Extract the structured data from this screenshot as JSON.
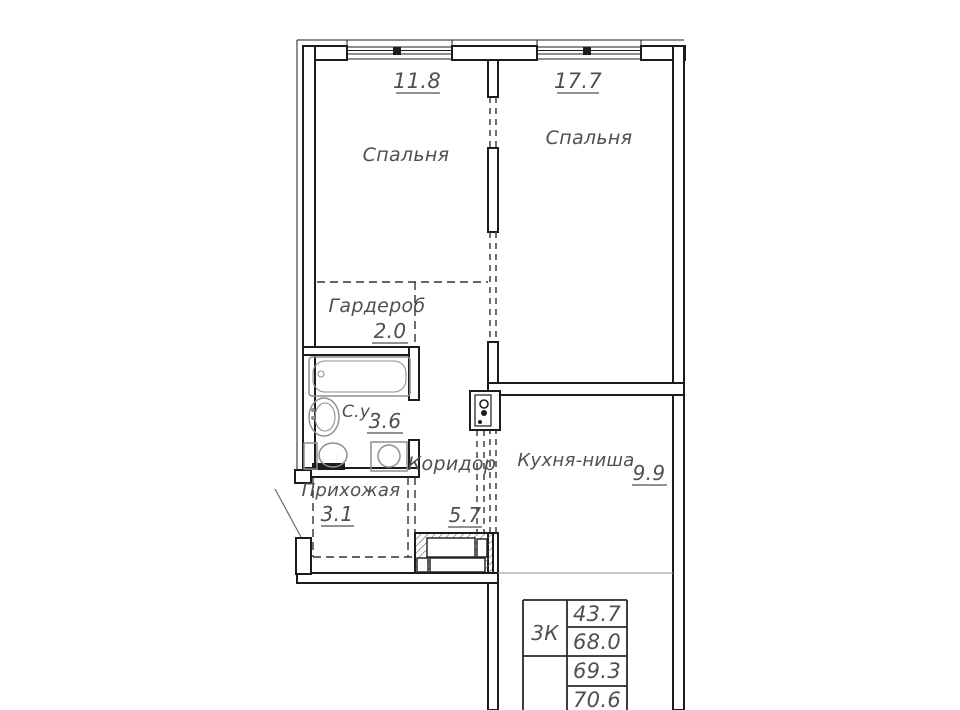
{
  "plan": {
    "title": "apartment-floor-plan",
    "rooms": [
      {
        "id": "bedroom-1",
        "name": "Спальня",
        "area": "11.8"
      },
      {
        "id": "bedroom-2",
        "name": "Спальня",
        "area": "17.7"
      },
      {
        "id": "wardrobe",
        "name": "Гардероб",
        "area": "2.0"
      },
      {
        "id": "bathroom",
        "name": "С.у.",
        "area": "3.6"
      },
      {
        "id": "corridor",
        "name": "Коридор",
        "area": "5.7"
      },
      {
        "id": "hallway",
        "name": "Прихожая",
        "area": "3.1"
      },
      {
        "id": "kitchen-niche",
        "name": "Кухня-ниша",
        "area": "9.9"
      }
    ],
    "table": {
      "unit_type": "3К",
      "values": [
        "43.7",
        "68.0",
        "69.3",
        "70.6"
      ]
    },
    "fixtures": [
      "bathtub-icon",
      "sink-icon",
      "toilet-icon",
      "washing-machine-icon",
      "kitchen-counter-icon",
      "electrical-panel-icon",
      "window-icon",
      "entrance-door-icon"
    ],
    "colors": {
      "wall": "#1c1c1c",
      "fixture": "#8f8f8f",
      "text": "#4f4f4f",
      "background": "#ffffff"
    }
  }
}
